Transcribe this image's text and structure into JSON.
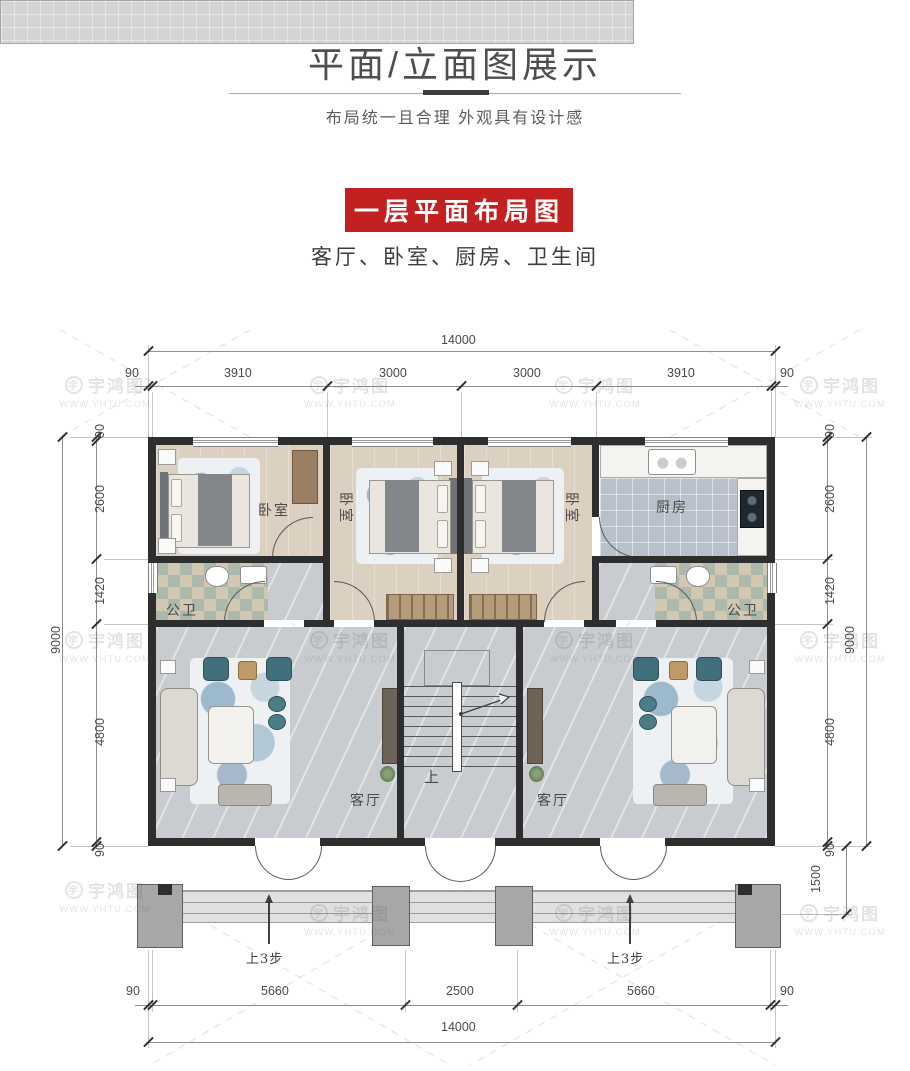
{
  "header": {
    "title": "平面/立面图展示",
    "subtitle": "布局统一且合理 外观具有设计感",
    "banner": "一层平面布局图",
    "rooms_line": "客厅、卧室、厨房、卫生间"
  },
  "watermark": {
    "logo_char": "宇",
    "name": "宇鸿图",
    "url": "WWW.YHTU.COM"
  },
  "plan": {
    "labels": {
      "bedroom": "卧室",
      "kitchen": "厨房",
      "bath": "公卫",
      "living": "客厅",
      "stairs_up": "上",
      "steps_note": "上3步"
    },
    "dims": {
      "top_total": "14000",
      "top_segments": [
        "90",
        "3910",
        "3000",
        "3000",
        "3910",
        "90"
      ],
      "left_total": "9000",
      "left_segments": [
        "90",
        "2600",
        "1420",
        "4800",
        "90"
      ],
      "right_total": "9000",
      "right_segments": [
        "90",
        "2600",
        "1420",
        "4800",
        "90"
      ],
      "porch_depth": "1500",
      "bottom_segments": [
        "90",
        "5660",
        "2500",
        "5660",
        "90"
      ],
      "bottom_total": "14000"
    },
    "colors": {
      "wall": "#2e2e2e",
      "accent_red": "#c32121",
      "teal": "#41707a"
    }
  }
}
